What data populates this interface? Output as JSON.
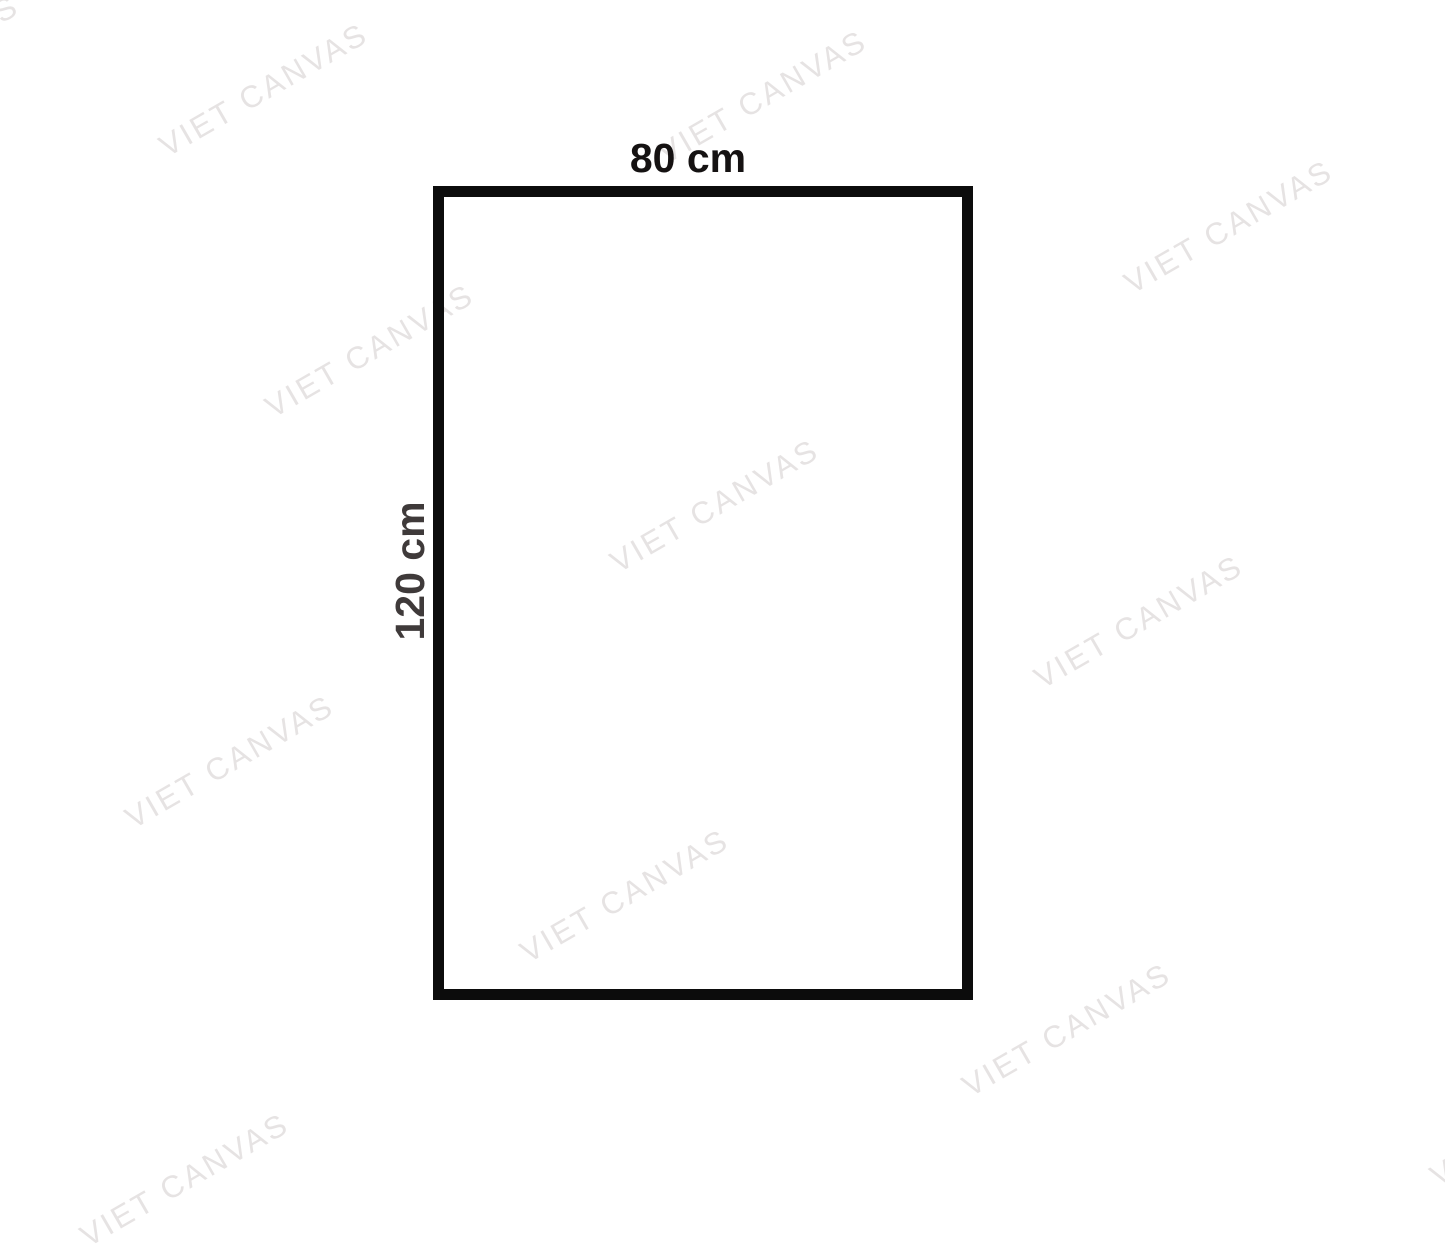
{
  "diagram": {
    "width_label": "80 cm",
    "height_label": "120 cm"
  },
  "colors": {
    "rect_border": "#0c0c0c",
    "width_label_text": "#151212",
    "height_label_text": "#3f3a3a",
    "watermark_text": "#e6e3e3",
    "background": "#ffffff"
  },
  "watermark": {
    "text": "VIET CANVAS",
    "color": "#e6e3e3",
    "rotation_deg": -30,
    "positions": [
      {
        "x": -85,
        "y": 62
      },
      {
        "x": 264,
        "y": 90
      },
      {
        "x": 763,
        "y": 97
      },
      {
        "x": 1229,
        "y": 227
      },
      {
        "x": 370,
        "y": 351
      },
      {
        "x": 715,
        "y": 506
      },
      {
        "x": 1139,
        "y": 622
      },
      {
        "x": 230,
        "y": 762
      },
      {
        "x": 625,
        "y": 896
      },
      {
        "x": 1067,
        "y": 1030
      },
      {
        "x": 185,
        "y": 1180
      },
      {
        "x": 1535,
        "y": 1120
      }
    ]
  }
}
